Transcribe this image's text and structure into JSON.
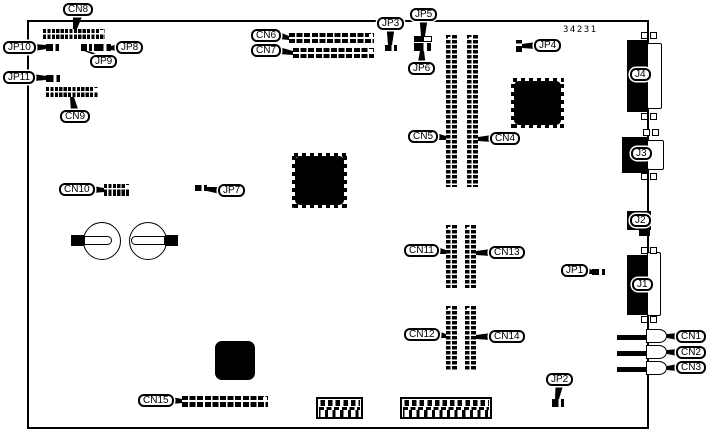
{
  "figure": {
    "part_number": "34231",
    "description": "Printed circuit board connector and jumper location diagram"
  },
  "board": {
    "x": 27,
    "y": 20,
    "w": 622,
    "h": 409
  },
  "part_number_pos": {
    "x": 563,
    "y": 25
  },
  "callouts": [
    {
      "text": "CN8",
      "x": 63,
      "y": 3,
      "dir": "down",
      "tx": 75,
      "ty": 29,
      "w1": 5
    },
    {
      "text": "JP10",
      "x": 3,
      "y": 41,
      "dir": "right",
      "tx": 46,
      "ty": 47
    },
    {
      "text": "JP8",
      "x": 116,
      "y": 41,
      "dir": "left",
      "tx": 111,
      "ty": 48
    },
    {
      "text": "JP9",
      "x": 90,
      "y": 55,
      "dir": "up",
      "tx": 86,
      "ty": 51
    },
    {
      "text": "JP11",
      "x": 3,
      "y": 71,
      "dir": "right",
      "tx": 46,
      "ty": 78
    },
    {
      "text": "CN9",
      "x": 60,
      "y": 110,
      "dir": "up",
      "tx": 72,
      "ty": 97
    },
    {
      "text": "CN6",
      "x": 251,
      "y": 29,
      "dir": "right",
      "tx": 289,
      "ty": 38
    },
    {
      "text": "CN7",
      "x": 251,
      "y": 44,
      "dir": "right",
      "tx": 293,
      "ty": 53
    },
    {
      "text": "JP3",
      "x": 377,
      "y": 17,
      "dir": "down",
      "tx": 390,
      "ty": 45
    },
    {
      "text": "JP5",
      "x": 410,
      "y": 8,
      "dir": "down",
      "tx": 423,
      "ty": 36
    },
    {
      "text": "JP6",
      "x": 408,
      "y": 62,
      "dir": "up",
      "tx": 422,
      "ty": 51
    },
    {
      "text": "JP4",
      "x": 534,
      "y": 39,
      "dir": "left",
      "tx": 522,
      "ty": 46
    },
    {
      "text": "CN5",
      "x": 408,
      "y": 130,
      "dir": "right",
      "tx": 446,
      "ty": 138
    },
    {
      "text": "CN4",
      "x": 490,
      "y": 132,
      "dir": "left",
      "tx": 478,
      "ty": 139
    },
    {
      "text": "CN10",
      "x": 59,
      "y": 183,
      "dir": "right",
      "tx": 104,
      "ty": 190
    },
    {
      "text": "JP7",
      "x": 218,
      "y": 184,
      "dir": "left",
      "tx": 207,
      "ty": 189
    },
    {
      "text": "JP1",
      "x": 561,
      "y": 264,
      "dir": "right",
      "tx": 592,
      "ty": 272
    },
    {
      "text": "CN11",
      "x": 404,
      "y": 244,
      "dir": "right",
      "tx": 446,
      "ty": 252
    },
    {
      "text": "CN13",
      "x": 489,
      "y": 246,
      "dir": "left",
      "tx": 476,
      "ty": 253
    },
    {
      "text": "CN12",
      "x": 404,
      "y": 328,
      "dir": "right",
      "tx": 446,
      "ty": 336
    },
    {
      "text": "CN14",
      "x": 489,
      "y": 330,
      "dir": "left",
      "tx": 476,
      "ty": 337
    },
    {
      "text": "JP2",
      "x": 546,
      "y": 373,
      "dir": "down",
      "tx": 557,
      "ty": 399
    },
    {
      "text": "CN15",
      "x": 138,
      "y": 394,
      "dir": "right",
      "tx": 182,
      "ty": 401
    },
    {
      "text": "CN1",
      "x": 676,
      "y": 330,
      "dir": "left",
      "tx": 667,
      "ty": 336
    },
    {
      "text": "CN2",
      "x": 676,
      "y": 346,
      "dir": "left",
      "tx": 667,
      "ty": 352
    },
    {
      "text": "CN3",
      "x": 676,
      "y": 361,
      "dir": "left",
      "tx": 667,
      "ty": 368
    },
    {
      "text": "J4",
      "x": 630,
      "y": 68,
      "dir": "none"
    },
    {
      "text": "J3",
      "x": 631,
      "y": 147,
      "dir": "none"
    },
    {
      "text": "J2",
      "x": 630,
      "y": 214,
      "dir": "none"
    },
    {
      "text": "J1",
      "x": 632,
      "y": 278,
      "dir": "none"
    }
  ],
  "parts": [
    {
      "cls": "hgrid",
      "name": "cn8-connector",
      "x": 43,
      "y": 29,
      "w": 62,
      "h": 10
    },
    {
      "cls": "hgrid",
      "name": "cn9-connector",
      "x": 46,
      "y": 87,
      "w": 53,
      "h": 10
    },
    {
      "cls": "hgrid",
      "name": "cn10-connector",
      "x": 104,
      "y": 184,
      "w": 26,
      "h": 12
    },
    {
      "cls": "xbar",
      "name": "cn6-connector",
      "x": 289,
      "y": 33,
      "w": 85,
      "h": 10
    },
    {
      "cls": "xbar",
      "name": "cn7-connector",
      "x": 293,
      "y": 48,
      "w": 81,
      "h": 10
    },
    {
      "cls": "xbar",
      "name": "cn15-connector",
      "x": 182,
      "y": 396,
      "w": 86,
      "h": 11
    },
    {
      "cls": "slot",
      "name": "cn5-slot",
      "x": 446,
      "y": 35,
      "w": 11,
      "h": 152
    },
    {
      "cls": "slot",
      "name": "cn4-slot",
      "x": 467,
      "y": 35,
      "w": 11,
      "h": 152
    },
    {
      "cls": "slot",
      "name": "cn11-slot",
      "x": 446,
      "y": 225,
      "w": 11,
      "h": 63
    },
    {
      "cls": "slot",
      "name": "cn13-slot",
      "x": 465,
      "y": 225,
      "w": 11,
      "h": 63
    },
    {
      "cls": "slot",
      "name": "cn12-slot",
      "x": 446,
      "y": 306,
      "w": 11,
      "h": 64
    },
    {
      "cls": "slot",
      "name": "cn14-slot",
      "x": 465,
      "y": 306,
      "w": 11,
      "h": 64
    },
    {
      "cls": "qfp",
      "name": "ic-chip-center",
      "x": 292,
      "y": 153,
      "w": 55,
      "h": 55
    },
    {
      "cls": "qfp",
      "name": "ic-chip-upper-right",
      "x": 511,
      "y": 78,
      "w": 53,
      "h": 50
    },
    {
      "cls": "chip-plain",
      "name": "ic-chip-bottom",
      "x": 215,
      "y": 341,
      "w": 40,
      "h": 39
    },
    {
      "cls": "circ",
      "name": "battery-left",
      "x": 83,
      "y": 222,
      "w": 38,
      "h": 38
    },
    {
      "cls": "circ",
      "name": "battery-right",
      "x": 129,
      "y": 222,
      "w": 38,
      "h": 38
    },
    {
      "cls": "fcap",
      "name": "fuse-left-cap",
      "x": 71,
      "y": 235,
      "w": 13,
      "h": 11
    },
    {
      "cls": "fbody-r",
      "name": "fuse-left-body",
      "x": 84,
      "y": 236,
      "w": 28,
      "h": 9
    },
    {
      "cls": "fbody-l",
      "name": "fuse-right-body",
      "x": 131,
      "y": 236,
      "w": 34,
      "h": 9
    },
    {
      "cls": "fcap",
      "name": "fuse-right-cap",
      "x": 165,
      "y": 235,
      "w": 13,
      "h": 11
    },
    {
      "cls": "blk",
      "name": "j4-connector-body",
      "x": 627,
      "y": 40,
      "w": 21,
      "h": 72
    },
    {
      "cls": "dwhite",
      "name": "j4-connector-face",
      "x": 647,
      "y": 43,
      "w": 15,
      "h": 66
    },
    {
      "cls": "screw",
      "name": "j4-screw-tab",
      "x": 641,
      "y": 32,
      "w": 7,
      "h": 7
    },
    {
      "cls": "screw",
      "name": "j4-screw-tab",
      "x": 650,
      "y": 32,
      "w": 7,
      "h": 7
    },
    {
      "cls": "screw",
      "name": "j4-screw-tab",
      "x": 641,
      "y": 113,
      "w": 7,
      "h": 7
    },
    {
      "cls": "screw",
      "name": "j4-screw-tab",
      "x": 650,
      "y": 113,
      "w": 7,
      "h": 7
    },
    {
      "cls": "blk",
      "name": "j3-connector-body",
      "x": 622,
      "y": 137,
      "w": 26,
      "h": 36
    },
    {
      "cls": "dwhite",
      "name": "j3-connector-face",
      "x": 647,
      "y": 140,
      "w": 17,
      "h": 30
    },
    {
      "cls": "screw",
      "name": "j3-screw-tab",
      "x": 643,
      "y": 129,
      "w": 7,
      "h": 7
    },
    {
      "cls": "screw",
      "name": "j3-screw-tab",
      "x": 652,
      "y": 129,
      "w": 7,
      "h": 7
    },
    {
      "cls": "screw",
      "name": "j3-screw-tab",
      "x": 641,
      "y": 173,
      "w": 7,
      "h": 7
    },
    {
      "cls": "screw",
      "name": "j3-screw-tab",
      "x": 650,
      "y": 173,
      "w": 7,
      "h": 7
    },
    {
      "cls": "blk",
      "name": "j2-connector-body",
      "x": 627,
      "y": 211,
      "w": 24,
      "h": 19
    },
    {
      "cls": "blk",
      "name": "j2-connector-stub",
      "x": 639,
      "y": 230,
      "w": 11,
      "h": 6
    },
    {
      "cls": "blk",
      "name": "j1-connector-body",
      "x": 627,
      "y": 255,
      "w": 21,
      "h": 60
    },
    {
      "cls": "dwhite",
      "name": "j1-connector-face",
      "x": 647,
      "y": 252,
      "w": 14,
      "h": 64
    },
    {
      "cls": "screw",
      "name": "j1-screw-tab",
      "x": 641,
      "y": 247,
      "w": 7,
      "h": 7
    },
    {
      "cls": "screw",
      "name": "j1-screw-tab",
      "x": 650,
      "y": 247,
      "w": 7,
      "h": 7
    },
    {
      "cls": "screw",
      "name": "j1-screw-tab",
      "x": 641,
      "y": 316,
      "w": 7,
      "h": 7
    },
    {
      "cls": "screw",
      "name": "j1-screw-tab",
      "x": 650,
      "y": 316,
      "w": 7,
      "h": 7
    },
    {
      "cls": "jbar",
      "name": "cn1-jack-pin",
      "x": 617,
      "y": 335,
      "w": 30,
      "h": 5
    },
    {
      "cls": "jack",
      "name": "cn1-jack",
      "x": 646,
      "y": 329,
      "w": 21,
      "h": 14
    },
    {
      "cls": "jbar",
      "name": "cn2-jack-pin",
      "x": 617,
      "y": 351,
      "w": 30,
      "h": 5
    },
    {
      "cls": "jack",
      "name": "cn2-jack",
      "x": 646,
      "y": 345,
      "w": 21,
      "h": 14
    },
    {
      "cls": "jbar",
      "name": "cn3-jack-pin",
      "x": 617,
      "y": 367,
      "w": 30,
      "h": 5
    },
    {
      "cls": "jack",
      "name": "cn3-jack",
      "x": 646,
      "y": 361,
      "w": 21,
      "h": 14
    },
    {
      "cls": "tb-frame",
      "name": "terminal-block-small",
      "x": 316,
      "y": 397,
      "w": 47,
      "h": 22
    },
    {
      "cls": "tb-bumps",
      "name": "terminal-block-small-contacts",
      "x": 319,
      "y": 400,
      "w": 41,
      "h": 6
    },
    {
      "cls": "tb-dash",
      "name": "terminal-block-small-divider",
      "x": 319,
      "y": 407,
      "w": 41,
      "h": 3
    },
    {
      "cls": "tb-cells",
      "name": "terminal-block-small-cells",
      "x": 319,
      "y": 410,
      "w": 41,
      "h": 7
    },
    {
      "cls": "tb-frame",
      "name": "terminal-block-large",
      "x": 400,
      "y": 397,
      "w": 92,
      "h": 22
    },
    {
      "cls": "tb-bumps",
      "name": "terminal-block-large-contacts",
      "x": 403,
      "y": 400,
      "w": 86,
      "h": 6
    },
    {
      "cls": "tb-dash",
      "name": "terminal-block-large-divider",
      "x": 403,
      "y": 407,
      "w": 86,
      "h": 3
    },
    {
      "cls": "tb-cells",
      "name": "terminal-block-large-cells",
      "x": 403,
      "y": 410,
      "w": 86,
      "h": 7
    },
    {
      "cls": "jmp",
      "name": "jp10-jumper",
      "x": 46,
      "y": 44,
      "w": 13,
      "h": 7
    },
    {
      "cls": "jmp",
      "name": "jp9-jumper",
      "x": 81,
      "y": 44,
      "w": 11,
      "h": 7
    },
    {
      "cls": "jmp",
      "name": "jp8-jumper",
      "x": 94,
      "y": 44,
      "w": 17,
      "h": 7
    },
    {
      "cls": "jmp",
      "name": "jp11-jumper",
      "x": 46,
      "y": 75,
      "w": 14,
      "h": 7
    },
    {
      "cls": "jmp",
      "name": "jp3-jumper",
      "x": 385,
      "y": 45,
      "w": 12,
      "h": 6
    },
    {
      "cls": "jmp-half",
      "name": "jp5-jumper",
      "x": 414,
      "y": 36,
      "w": 18,
      "h": 6
    },
    {
      "cls": "jmp",
      "name": "jp6-jumper",
      "x": 414,
      "y": 43,
      "w": 17,
      "h": 8
    },
    {
      "cls": "jmpv",
      "name": "jp4-jumper",
      "x": 516,
      "y": 40,
      "w": 6,
      "h": 12
    },
    {
      "cls": "jmp",
      "name": "jp7-jumper",
      "x": 195,
      "y": 185,
      "w": 12,
      "h": 6
    },
    {
      "cls": "jmp",
      "name": "jp1-jumper",
      "x": 592,
      "y": 269,
      "w": 13,
      "h": 6
    },
    {
      "cls": "jmp",
      "name": "jp2-jumper",
      "x": 552,
      "y": 399,
      "w": 12,
      "h": 8
    }
  ]
}
